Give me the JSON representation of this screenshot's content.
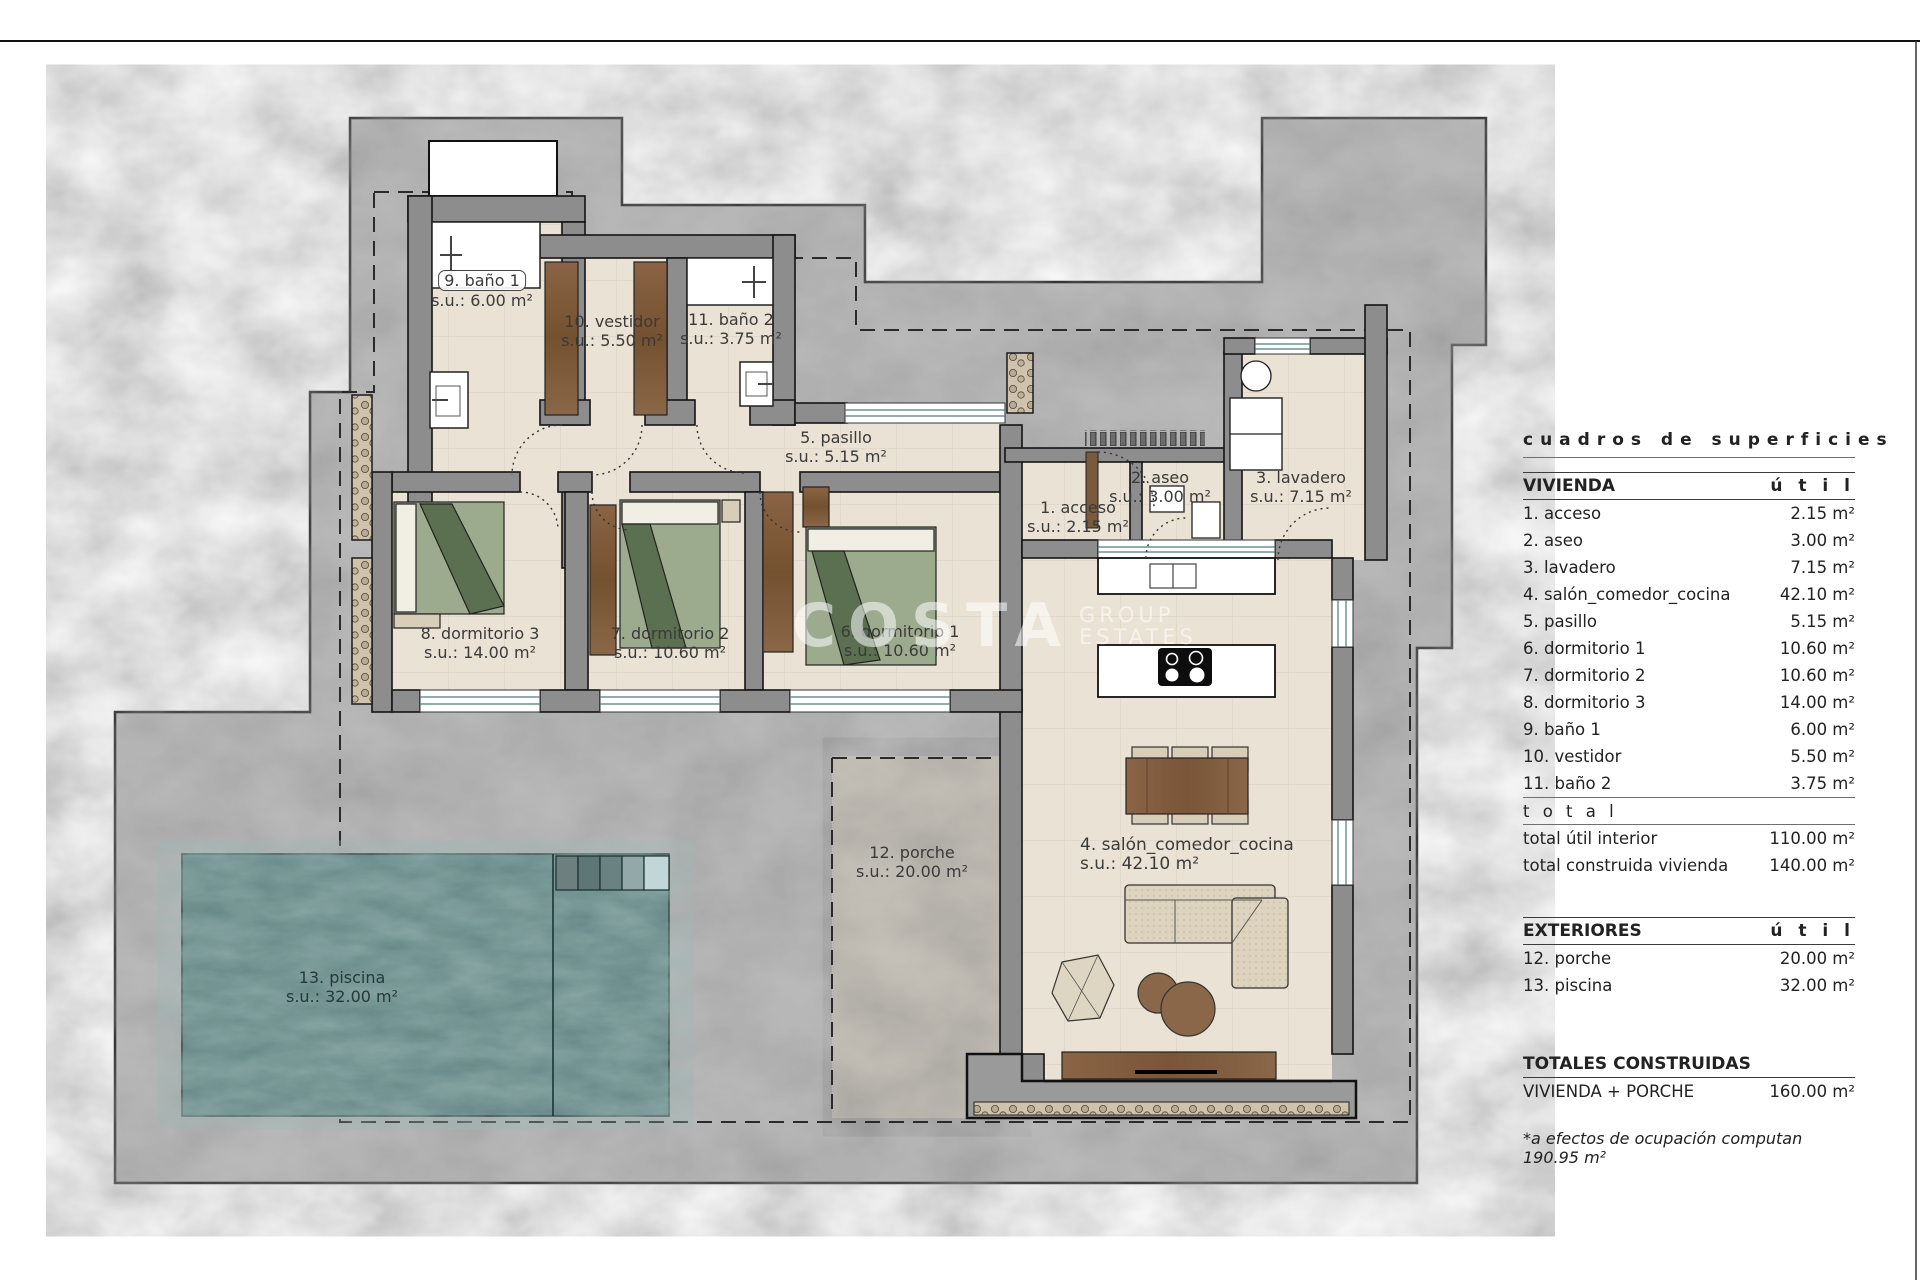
{
  "palette": {
    "plot_gray": "#bdbdbd",
    "wall_gray": "#8d8d8d",
    "floor_beige": "#eae2d4",
    "wood_brown": "#7d5a3c",
    "bed_green": "#9cab8e",
    "pool_teal": "#5d8282",
    "porch_gray": "#c9c4ba",
    "line_black": "#1a1a1a"
  },
  "watermark": {
    "big": "COSTA",
    "sub1": "GROUP",
    "sub2": "ESTATES"
  },
  "plan": {
    "labels": {
      "acceso": {
        "name": "1. acceso",
        "area": "s.u.: 2.15 m²"
      },
      "aseo": {
        "name": "2. aseo",
        "area": "s.u.: 3.00 m²"
      },
      "lavadero": {
        "name": "3. lavadero",
        "area": "s.u.: 7.15 m²"
      },
      "salon": {
        "name": "4. salón_comedor_cocina",
        "area": "s.u.: 42.10 m²"
      },
      "pasillo": {
        "name": "5. pasillo",
        "area": "s.u.: 5.15 m²"
      },
      "dorm1": {
        "name": "6. dormitorio 1",
        "area": "s.u.: 10.60 m²"
      },
      "dorm2": {
        "name": "7. dormitorio 2",
        "area": "s.u.: 10.60 m²"
      },
      "dorm3": {
        "name": "8. dormitorio 3",
        "area": "s.u.: 14.00 m²"
      },
      "banio1": {
        "name": "9. baño 1",
        "area": "s.u.: 6.00 m²"
      },
      "vestidor": {
        "name": "10. vestidor",
        "area": "s.u.: 5.50 m²"
      },
      "banio2": {
        "name": "11. baño 2",
        "area": "s.u.: 3.75 m²"
      },
      "porche": {
        "name": "12. porche",
        "area": "s.u.: 20.00 m²"
      },
      "piscina": {
        "name": "13. piscina",
        "area": "s.u.: 32.00 m²"
      }
    }
  },
  "table": {
    "title": "cuadros de superficies",
    "vivienda": {
      "header": "VIVIENDA",
      "unit_header": "ú  t  i  l",
      "rows": [
        {
          "label": "1. acceso",
          "area": "2.15 m²"
        },
        {
          "label": "2. aseo",
          "area": "3.00 m²"
        },
        {
          "label": "3. lavadero",
          "area": "7.15 m²"
        },
        {
          "label": "4. salón_comedor_cocina",
          "area": "42.10 m²"
        },
        {
          "label": "5. pasillo",
          "area": "5.15 m²"
        },
        {
          "label": "6. dormitorio 1",
          "area": "10.60 m²"
        },
        {
          "label": "7. dormitorio 2",
          "area": "10.60 m²"
        },
        {
          "label": "8. dormitorio 3",
          "area": "14.00 m²"
        },
        {
          "label": "9. baño 1",
          "area": "6.00 m²"
        },
        {
          "label": "10. vestidor",
          "area": "5.50 m²"
        },
        {
          "label": "11. baño 2",
          "area": "3.75 m²"
        }
      ],
      "total_caption": "t o t a l",
      "totals": [
        {
          "label": "total útil interior",
          "area": "110.00 m²"
        },
        {
          "label": "total construida vivienda",
          "area": "140.00 m²"
        }
      ]
    },
    "exteriores": {
      "header": "EXTERIORES",
      "unit_header": "ú  t  i  l",
      "rows": [
        {
          "label": "12. porche",
          "area": "20.00 m²"
        },
        {
          "label": "13. piscina",
          "area": "32.00 m²"
        }
      ]
    },
    "totales": {
      "header": "TOTALES CONSTRUIDAS",
      "rows": [
        {
          "label": "VIVIENDA + PORCHE",
          "area": "160.00 m²"
        }
      ]
    },
    "footnote": "*a efectos de ocupación computan 190.95 m²"
  }
}
